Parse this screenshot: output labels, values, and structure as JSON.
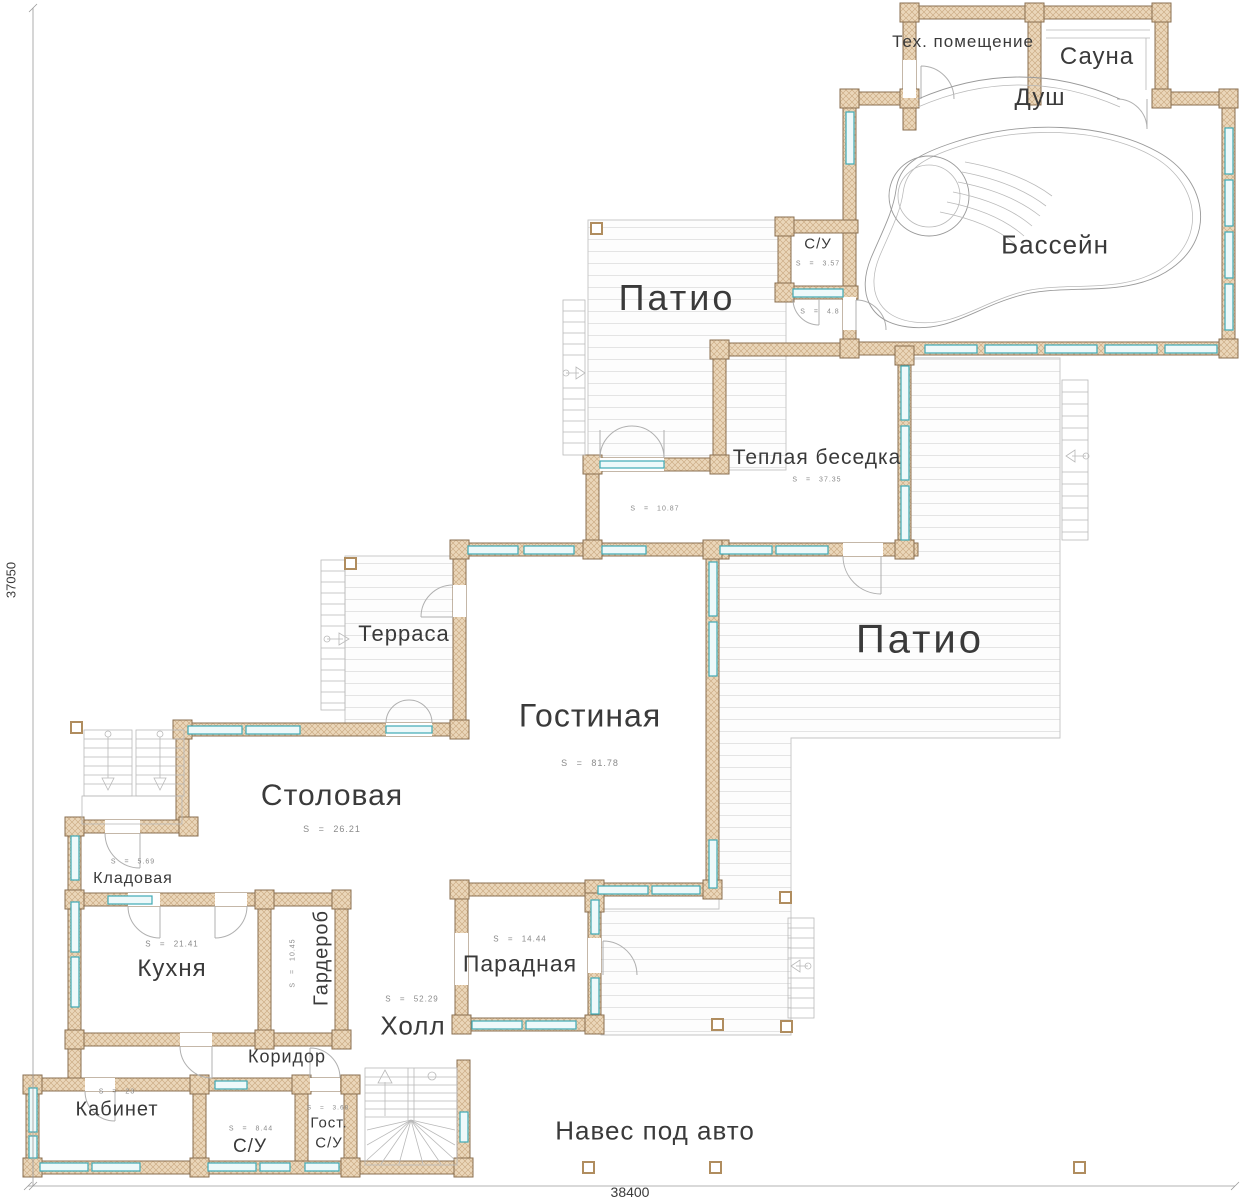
{
  "drawing": {
    "dimension_bottom": "38400",
    "dimension_left": "37050"
  },
  "rooms": {
    "tech": {
      "label": "Тех. помещение"
    },
    "sauna": {
      "label": "Сауна"
    },
    "shower": {
      "label": "Душ"
    },
    "pool": {
      "label": "Бассейн"
    },
    "wc_top": {
      "label": "С/У",
      "area": "S = 3.57"
    },
    "pool_entry": {
      "area": "S = 4.8"
    },
    "patio_top": {
      "label": "Патио"
    },
    "gazebo": {
      "label": "Теплая беседка",
      "area": "S = 37.35"
    },
    "gazebo_entry": {
      "area": "S = 10.87"
    },
    "terrace": {
      "label": "Терраса"
    },
    "living": {
      "label": "Гостиная",
      "area": "S = 81.78"
    },
    "patio_main": {
      "label": "Патио"
    },
    "dining": {
      "label": "Столовая",
      "area": "S = 26.21"
    },
    "pantry": {
      "label": "Кладовая",
      "area": "S = 5.69"
    },
    "kitchen": {
      "label": "Кухня",
      "area": "S = 21.41"
    },
    "wardrobe": {
      "label": "Гардероб",
      "area": "S = 10.45"
    },
    "front_room": {
      "label": "Парадная",
      "area": "S = 14.44"
    },
    "hall": {
      "label": "Холл",
      "area": "S = 52.29"
    },
    "corridor": {
      "label": "Коридор"
    },
    "office": {
      "label": "Кабинет",
      "area": "S = 23"
    },
    "wc_bottom": {
      "label": "С/У",
      "area": "S = 8.44"
    },
    "guest_wc": {
      "label_line1": "Гост.",
      "label_line2": "С/У",
      "area": "S = 3.68"
    },
    "carport": {
      "label": "Навес под авто"
    }
  },
  "colors": {
    "wall_fill": "#ead6b9",
    "wall_stroke": "#8a6f50",
    "window_accent": "#3fa9b5",
    "deck_line": "#e4e4e4",
    "text": "#3a3a3a"
  }
}
